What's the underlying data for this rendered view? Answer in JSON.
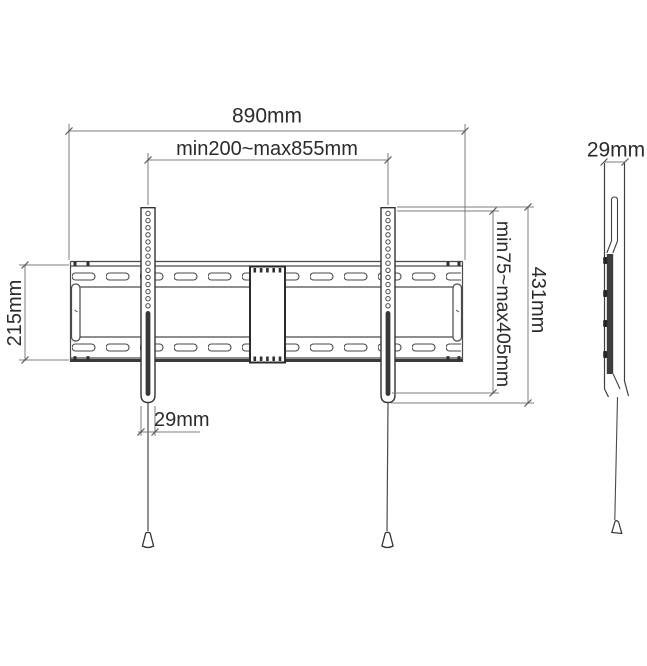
{
  "drawing": {
    "subject": "tv-wall-mount-technical-drawing",
    "background_color": "#ffffff",
    "outline_color": "#3f3f3f",
    "dim_line_color": "#7d7d7d",
    "text_color": "#2b2b2b",
    "dark_fill_color": "#383838",
    "front_view": {
      "width_total": "890mm",
      "width_range": "min200~max855mm",
      "plate_height": "215mm",
      "arm_width": "29mm",
      "height_range": "min75~max405mm",
      "arm_height": "431mm"
    },
    "side_view": {
      "depth": "29mm"
    }
  }
}
